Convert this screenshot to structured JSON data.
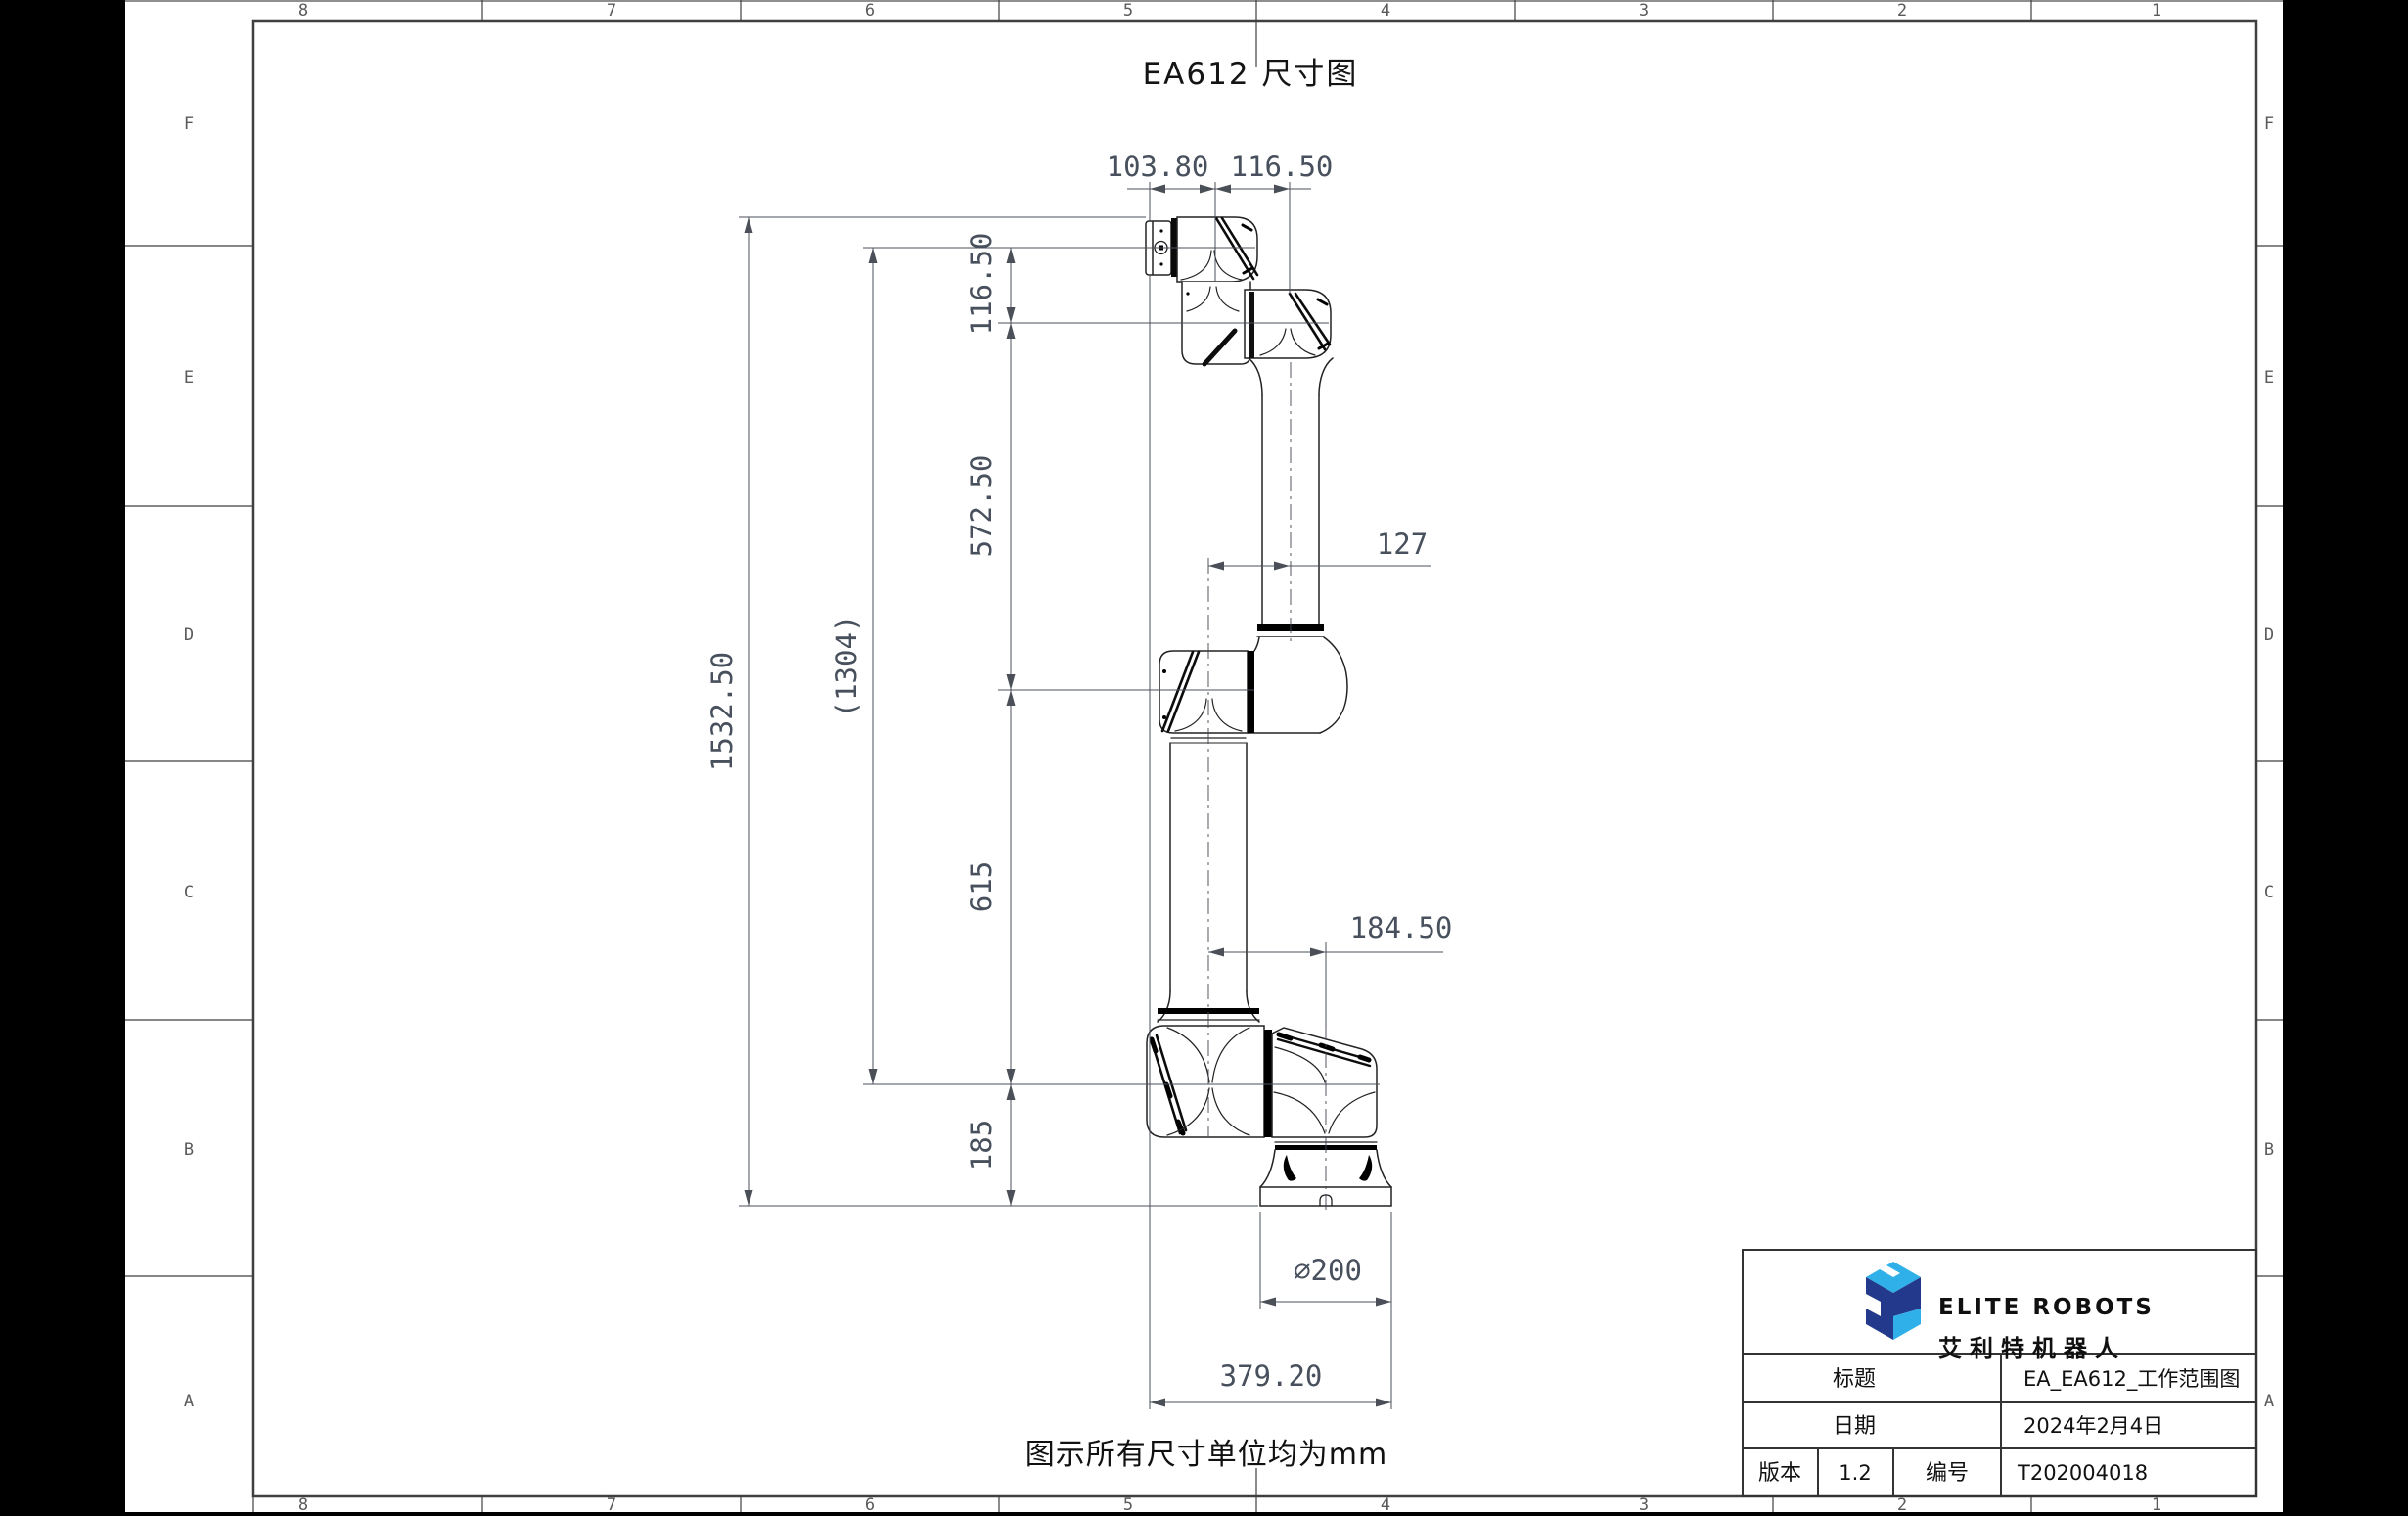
{
  "title": "EA612 尺寸图",
  "unit_note": "图示所有尺寸单位均为mm",
  "zones": {
    "columns": [
      "8",
      "7",
      "6",
      "5",
      "4",
      "3",
      "2",
      "1"
    ],
    "rows": [
      "F",
      "E",
      "D",
      "C",
      "B",
      "A"
    ]
  },
  "dimensions": {
    "top_flange_offset": "103.80",
    "top_wrist_offset": "116.50",
    "wrist_drop": "116.50",
    "upper_link": "572.50",
    "lower_link": "615",
    "base_height": "185",
    "overall_height": "1532.50",
    "flange_to_shoulder": "(1304)",
    "elbow_offset": "127",
    "shoulder_offset": "184.50",
    "base_diameter": "∅200",
    "overall_width": "379.20"
  },
  "title_block": {
    "brand_en": "ELITE ROBOTS",
    "brand_cn": "艾利特机器人",
    "title_label": "标题",
    "title_value": "EA_EA612_工作范围图",
    "date_label": "日期",
    "date_value": "2024年2月4日",
    "version_label": "版本",
    "version_value": "1.2",
    "number_label": "编号",
    "number_value": "T202004018"
  },
  "colors": {
    "logo_dark": "#233a8c",
    "logo_light": "#2fb0e8",
    "frame_line": "#3f3f3f",
    "dim_text": "#47505c"
  }
}
